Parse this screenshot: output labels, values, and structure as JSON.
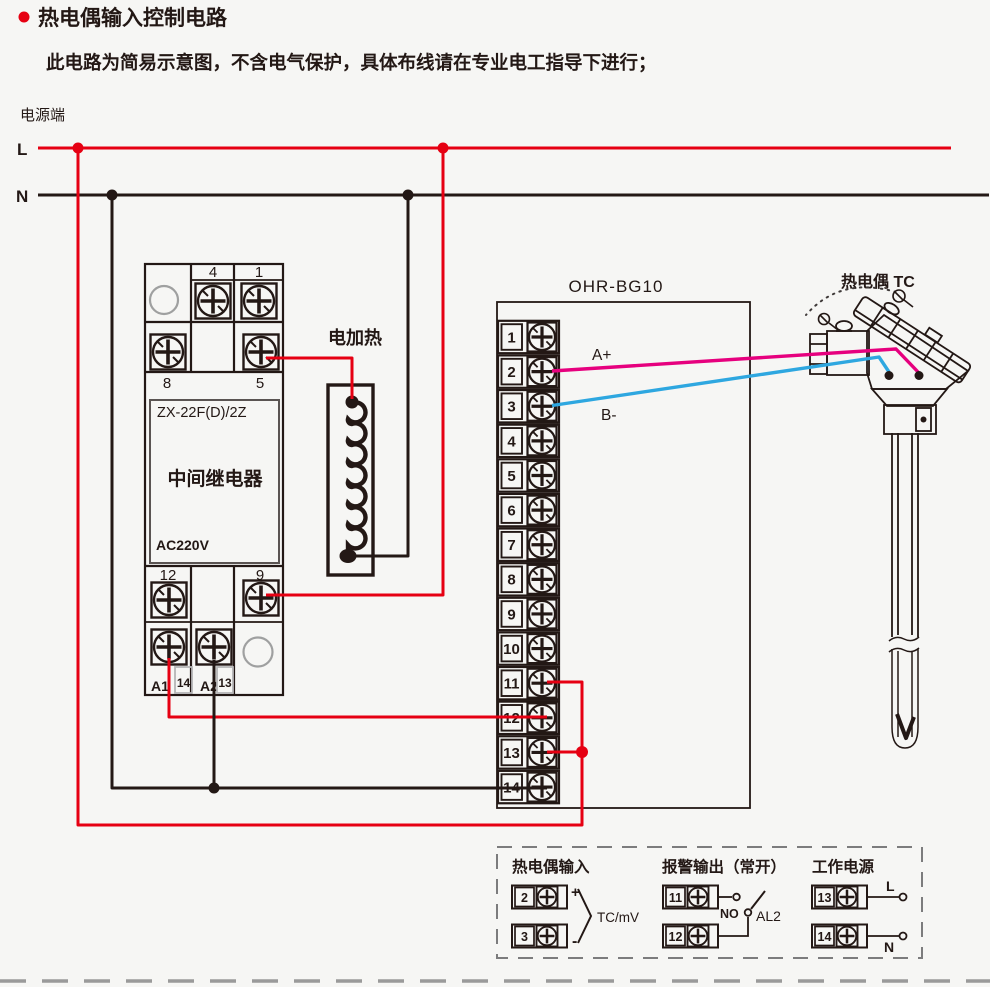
{
  "header": {
    "title": "热电偶输入控制电路",
    "subtitle": "此电路为简易示意图，不含电气保护，具体布线请在专业电工指导下进行；"
  },
  "power": {
    "label": "电源端",
    "live": "L",
    "neutral": "N"
  },
  "relay": {
    "model": "ZX-22F(D)/2Z",
    "name": "中间继电器",
    "voltage": "AC220V",
    "row1": [
      "4",
      "1"
    ],
    "row2": [
      "8",
      "5"
    ],
    "row3": [
      "12",
      "9"
    ],
    "row4": [
      "A1",
      "14",
      "A2",
      "13"
    ]
  },
  "heater": {
    "label": "电加热"
  },
  "controller": {
    "model": "OHR-BG10",
    "terminals": [
      "1",
      "2",
      "3",
      "4",
      "5",
      "6",
      "7",
      "8",
      "9",
      "10",
      "11",
      "12",
      "13",
      "14"
    ],
    "wire_a": "A+",
    "wire_b": "B-"
  },
  "thermocouple": {
    "label": "热电偶 TC"
  },
  "legend": {
    "sections": [
      {
        "title": "热电偶输入",
        "terminals": [
          "2",
          "3"
        ],
        "plus": "+",
        "minus": "-",
        "note": "TC/mV"
      },
      {
        "title": "报警输出（常开）",
        "terminals": [
          "11",
          "12"
        ],
        "contact": "NO",
        "output": "AL2"
      },
      {
        "title": "工作电源",
        "terminals": [
          "13",
          "14"
        ],
        "live": "L",
        "neutral": "N"
      }
    ]
  },
  "colors": {
    "background": "#f6f6f4",
    "accent_red": "#e60012",
    "wire_black": "#231815",
    "wire_magenta": "#e6007e",
    "wire_blue": "#2ea7e0"
  }
}
